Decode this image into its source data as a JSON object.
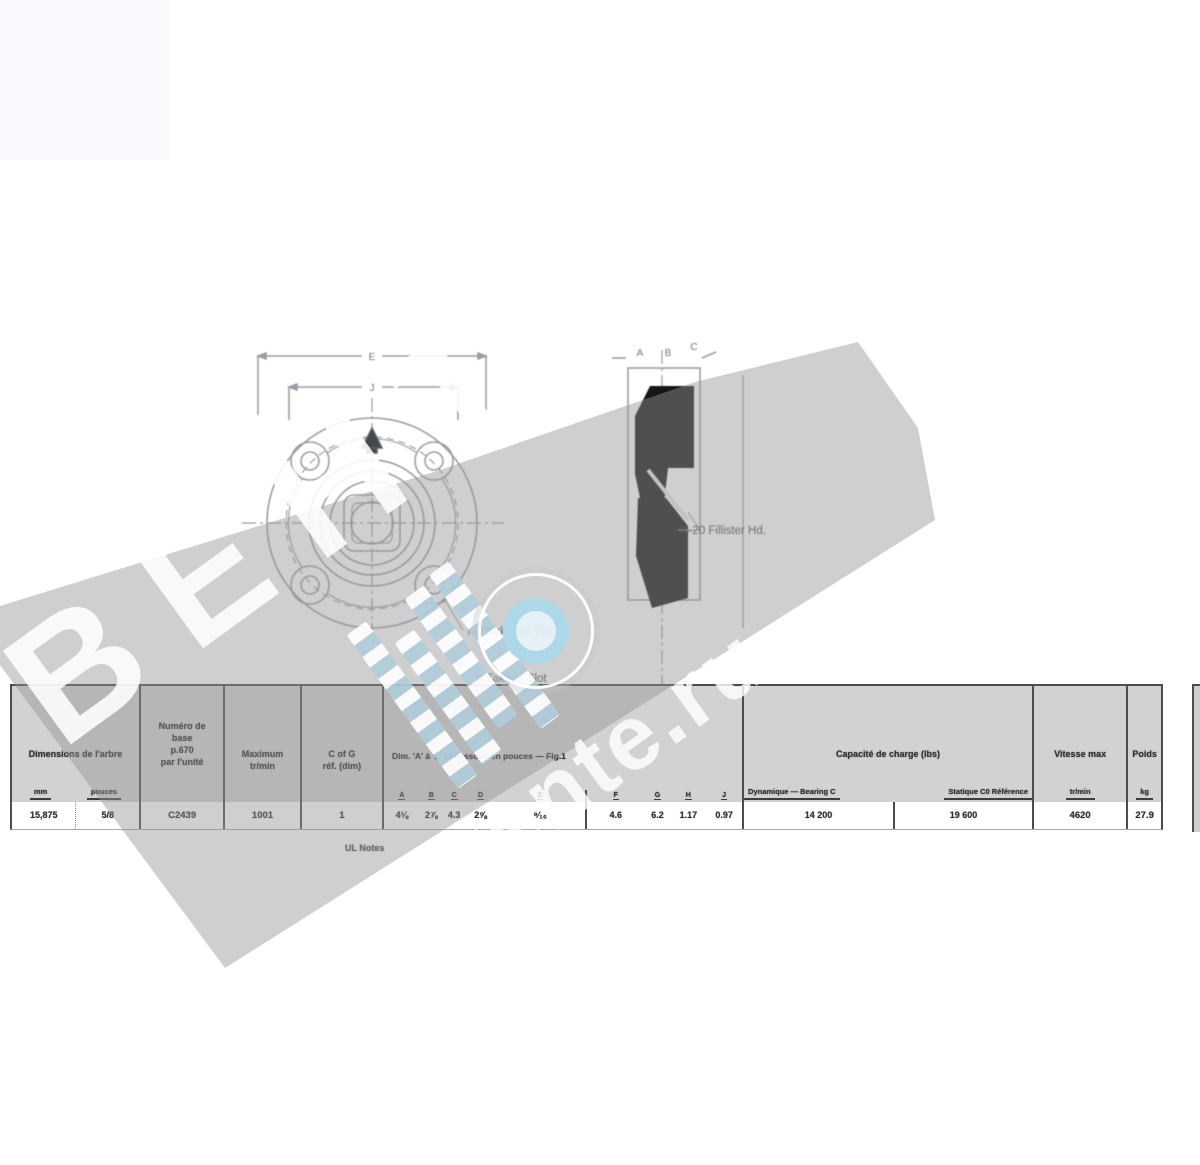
{
  "watermark": {
    "brand_text": "ВЕНТ",
    "site_text": "movente.ru"
  },
  "drawing": {
    "front_view": {
      "dim_outer_label": "E",
      "dim_inner_label": "J"
    },
    "section_view": {
      "dim_label_a": "A",
      "dim_label_b": "B",
      "dim_label_c": "C"
    },
    "annotations": {
      "fillister": "¼-20 Fillister Hd.",
      "thickness": "⅞ Thickness Thru",
      "takeup": "⅝ Takeup Slot"
    },
    "footnote": "UL Notes"
  },
  "table": {
    "shaft": {
      "header": "Dimensions de l'arbre",
      "sub_mm": "mm",
      "sub_in": "pouces",
      "val_mm": "15,875",
      "val_in": "5/8"
    },
    "bearing": {
      "line1": "Numéro de",
      "line2": "base",
      "line3": "p.670",
      "line4": "par l'unité",
      "value": "C2439"
    },
    "rpm": {
      "line1": "Maximum",
      "line2": "tr/min",
      "value": "1001"
    },
    "cofg": {
      "line1": "C of G",
      "line2": "réf. (dim)",
      "value": "1"
    },
    "dims": {
      "header": "Dim. 'A' à 'L' ci-dessous en pouces — Fig.1",
      "letters": [
        "A",
        "B",
        "C",
        "D",
        "E",
        "F",
        "G",
        "H",
        "J"
      ],
      "values": [
        "4⅛",
        "2⅞",
        "4.3",
        "2⅝",
        "⁹⁄₁₆",
        "4.6",
        "6.2",
        "1.17",
        "0.97"
      ]
    },
    "load": {
      "header": "Capacité de charge (lbs)",
      "sub_dyn": "Dynamique — Bearing C",
      "sub_stat": "Statique C0 Référence",
      "val_dyn": "14 200",
      "val_stat": "19 600"
    },
    "speed": {
      "header": "Vitesse max",
      "sub": "tr/min",
      "value": "4620"
    },
    "weight": {
      "header": "Poids",
      "sub": "kg",
      "value": "27.9"
    }
  }
}
